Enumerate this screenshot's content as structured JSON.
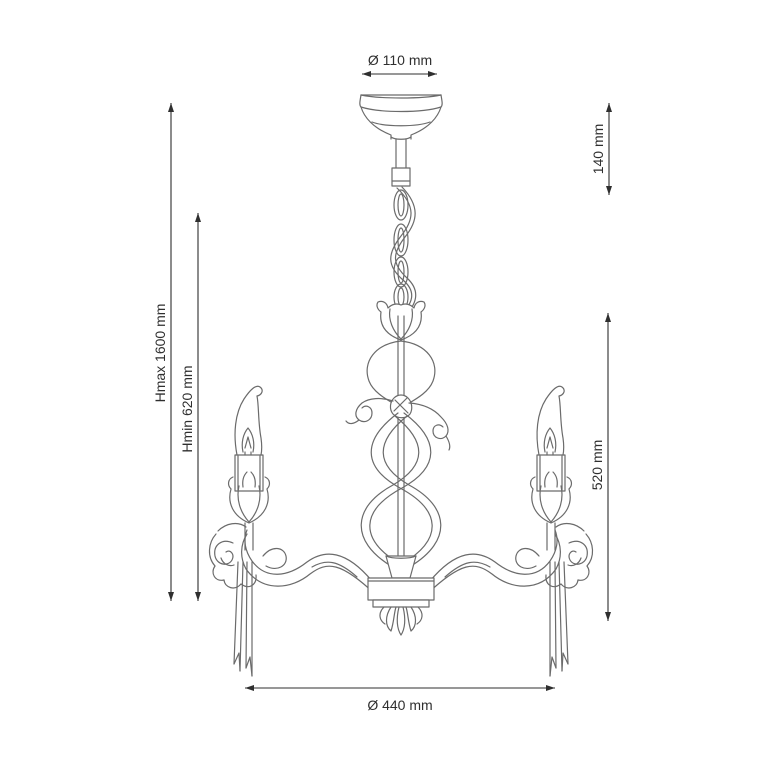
{
  "figure": {
    "subject": "three-arm-chandelier-technical-drawing"
  },
  "dimensions": {
    "canopy_diameter": "Ø 110 mm",
    "suspension_length": "140 mm",
    "max_height": "Hmax 1600 mm",
    "min_height": "Hmin 620 mm",
    "body_height": "520 mm",
    "body_diameter": "Ø 440 mm"
  },
  "colors": {
    "background": "#ffffff",
    "artwork_line": "#6b6b6b",
    "dimension_line": "#2f2f2f",
    "label_text": "#2f2f2f"
  }
}
